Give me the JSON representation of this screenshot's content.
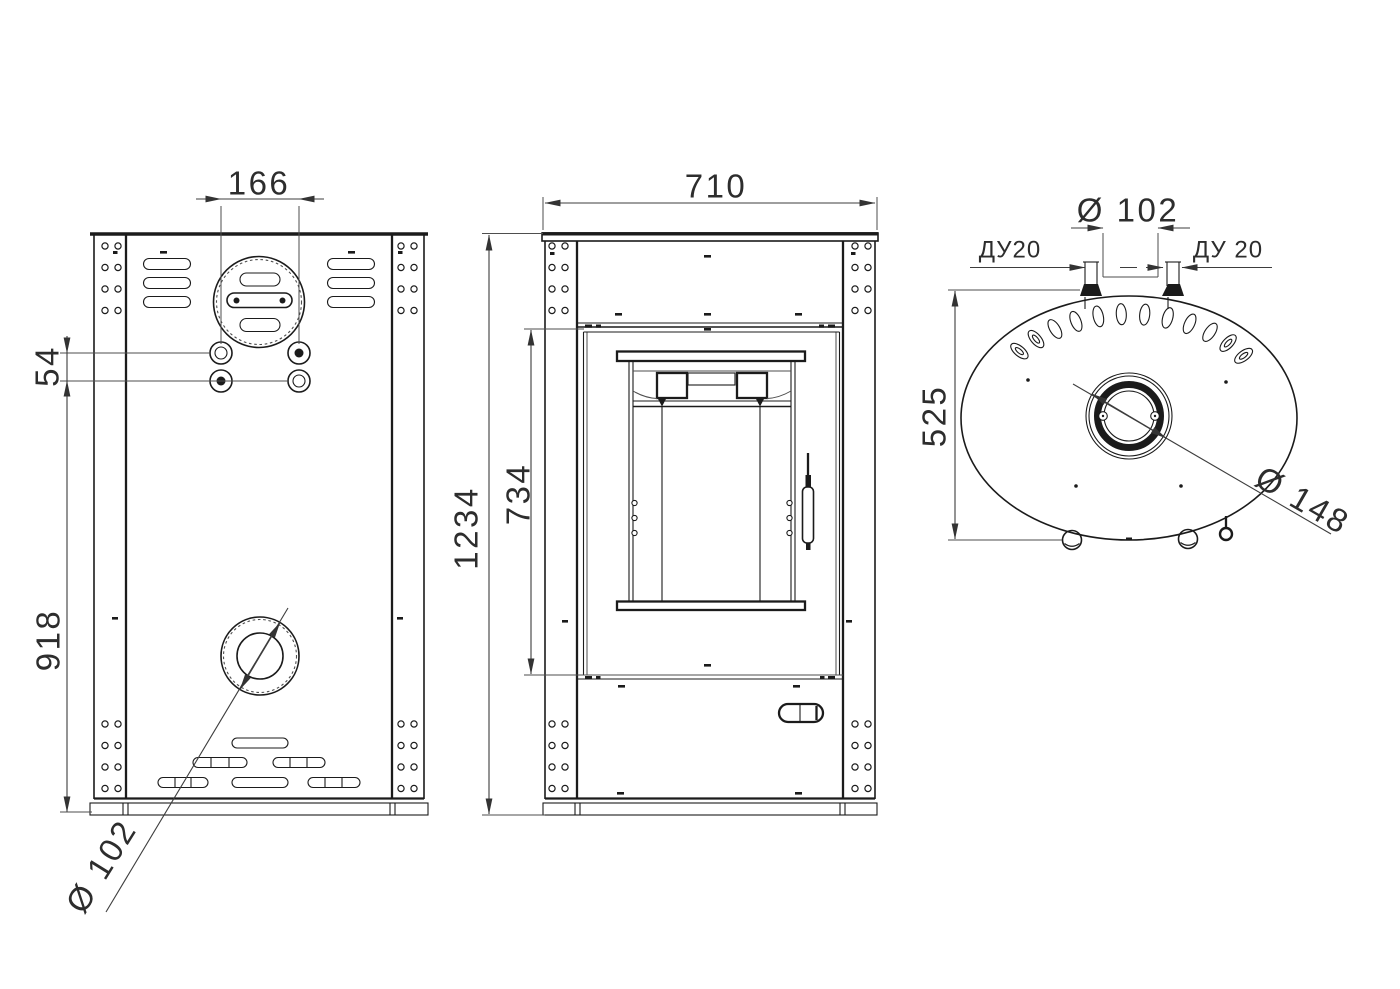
{
  "drawing": {
    "kind": "stove-technical-drawing",
    "colors": {
      "line": "#1b1b1b",
      "background": "#ffffff"
    },
    "rear": {
      "dim_166": "166",
      "dim_54": "54",
      "dim_918": "918",
      "dim_flue": "Ø 102"
    },
    "front": {
      "dim_710": "710",
      "dim_1234": "1234",
      "dim_734": "734"
    },
    "top": {
      "dim_102": "Ø 102",
      "du20_left": "ДУ20",
      "du20_right": "ДУ 20",
      "dim_525": "525",
      "dim_148": "Ø 148"
    }
  }
}
